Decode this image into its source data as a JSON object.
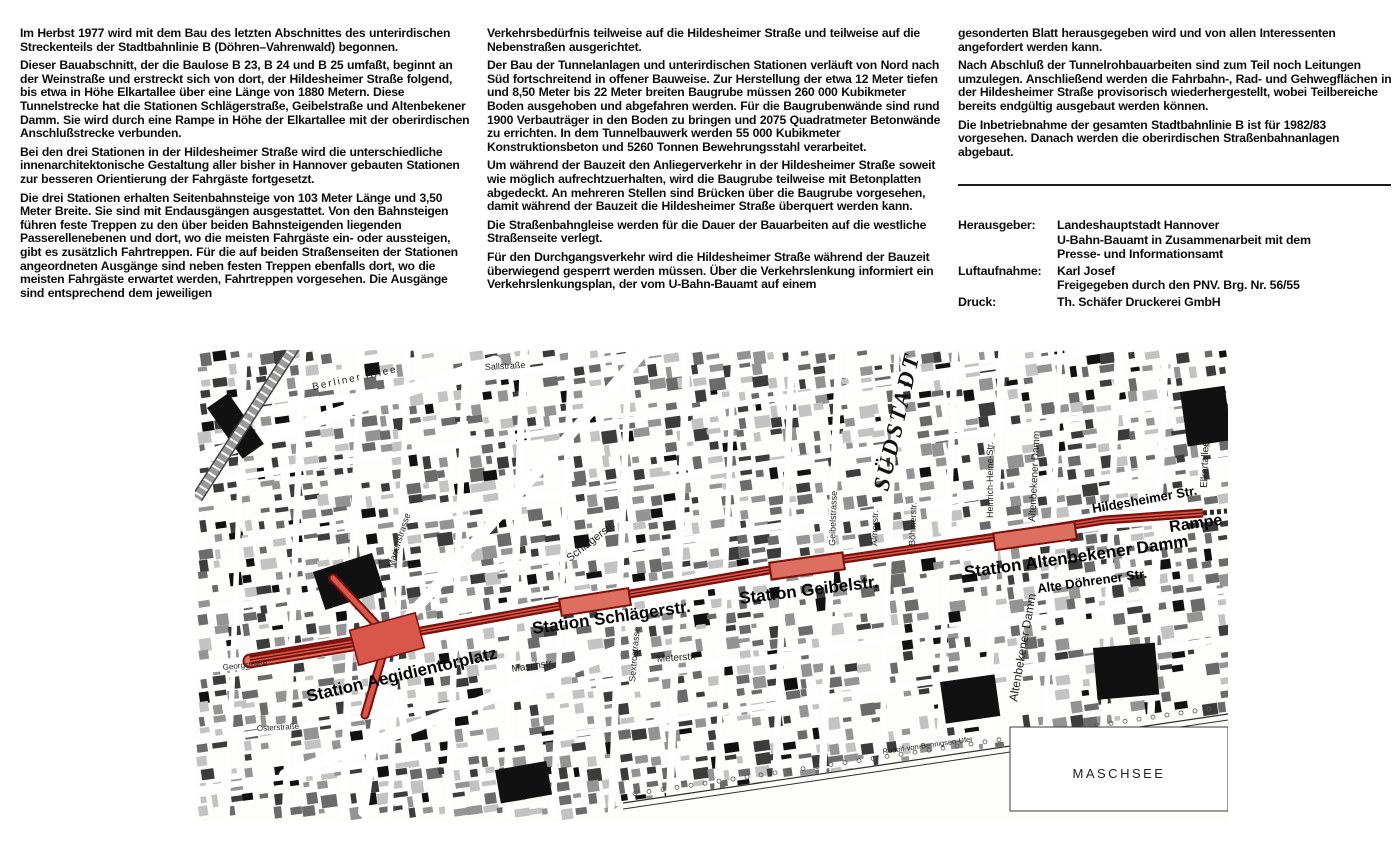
{
  "page": {
    "background": "#ffffff",
    "title": "Stadtbahnlinie B Hannover – Bauabschnitt Hildesheimer Straße"
  },
  "columns": [
    {
      "paragraphs": [
        "Im Herbst 1977 wird mit dem Bau des letzten Abschnittes des unterirdischen Streckenteils der Stadtbahnlinie B (Döhren–Vahrenwald) begonnen.",
        "Dieser Bauabschnitt, der die Baulose B 23, B 24 und B 25 umfaßt, beginnt an der Weinstraße und erstreckt sich von dort, der Hildesheimer Straße folgend, bis etwa in Höhe Elkartallee über eine Länge von 1880 Metern. Diese Tunnelstrecke hat die Stationen Schlägerstraße, Geibelstraße und Altenbekener Damm. Sie wird durch eine Rampe in Höhe der Elkartallee mit der oberirdischen Anschlußstrecke verbunden.",
        "Bei den drei Stationen in der Hildesheimer Straße wird die unterschiedliche innenarchitektonische Gestaltung aller bisher in Hannover gebauten Stationen zur besseren Orientierung der Fahrgäste fortgesetzt.",
        "Die drei Stationen erhalten Seitenbahnsteige von 103 Meter Länge und 3,50 Meter Breite. Sie sind mit Endausgängen ausgestattet. Von den Bahnsteigen führen feste Treppen zu den über beiden Bahnsteigenden liegenden Passerellenebenen und dort, wo die meisten Fahrgäste ein- oder aussteigen, gibt es zusätzlich Fahrtreppen. Für die auf beiden Straßenseiten der Stationen angeordneten Ausgänge sind neben festen Treppen ebenfalls dort, wo die meisten Fahrgäste erwartet werden, Fahrtreppen vorgesehen. Die Ausgänge sind entsprechend dem jeweiligen"
      ]
    },
    {
      "paragraphs": [
        "Verkehrsbedürfnis teilweise auf die Hildesheimer Straße und teilweise auf die Nebenstraßen ausgerichtet.",
        "Der Bau der Tunnelanlagen und unterirdischen Stationen verläuft von Nord nach Süd fortschreitend in offener Bauweise. Zur Herstellung der etwa 12 Meter tiefen und 8,50 Meter bis 22 Meter breiten Baugrube müssen 260 000 Kubikmeter Boden ausgehoben und abgefahren werden. Für die Baugrubenwände sind rund 1900 Verbauträger in den Boden zu bringen und 2075 Quadratmeter Betonwände zu errichten. In dem Tunnelbauwerk werden 55 000 Kubikmeter Konstruktionsbeton und 5260 Tonnen Bewehrungsstahl verarbeitet.",
        "Um während der Bauzeit den Anliegerverkehr in der Hildesheimer Straße soweit wie möglich aufrechtzuerhalten, wird die Baugrube teilweise mit Betonplatten abgedeckt. An mehreren Stellen sind Brücken über die Baugrube vorgesehen, damit während der Bauzeit die Hildesheimer Straße überquert werden kann.",
        "Die Straßenbahngleise werden für die Dauer der Bauarbeiten auf die westliche Straßenseite verlegt.",
        "Für den Durchgangsverkehr wird die Hildesheimer Straße während der Bauzeit überwiegend gesperrt werden müssen. Über die Verkehrslenkung informiert ein Verkehrslenkungsplan, der vom U-Bahn-Bauamt auf einem"
      ]
    },
    {
      "paragraphs": [
        "gesonderten Blatt herausgegeben wird und von allen Interessenten angefordert werden kann.",
        "Nach Abschluß der Tunnelrohbauarbeiten sind zum Teil noch Leitungen umzulegen. Anschließend werden die Fahrbahn-, Rad- und Gehwegflächen in der Hildesheimer Straße provisorisch wiederhergestellt, wobei Teilbereiche bereits endgültig ausgebaut werden können.",
        "Die Inbetriebnahme der gesamten Stadtbahnlinie B ist für 1982/83 vorgesehen. Danach werden die oberirdischen Straßenbahnanlagen abgebaut."
      ]
    }
  ],
  "imprint": {
    "rows": [
      {
        "label": "Herausgeber:",
        "lines": [
          "Landeshauptstadt Hannover",
          "U-Bahn-Bauamt in Zusammenarbeit mit dem",
          "Presse- und Informationsamt"
        ]
      },
      {
        "label": "Luftaufnahme:",
        "lines": [
          "Karl Josef",
          "Freigegeben durch den PNV. Brg. Nr. 56/55"
        ]
      },
      {
        "label": "Druck:",
        "lines": [
          "Th. Schäfer Druckerei GmbH"
        ]
      }
    ]
  },
  "map": {
    "colors": {
      "route_dark": "#7c100a",
      "route_fill": "#d8564a",
      "station_fill": "#dd6f60",
      "building_dark": "#111111",
      "label": "#1a1a1a"
    },
    "route": {
      "main": [
        [
          55,
          310
        ],
        [
          193,
          287
        ],
        [
          370,
          255
        ],
        [
          500,
          233
        ],
        [
          580,
          219
        ],
        [
          815,
          185
        ],
        [
          910,
          170
        ],
        [
          1008,
          163
        ]
      ],
      "approach": [
        [
          55,
          311
        ],
        [
          193,
          288
        ]
      ],
      "branches": [
        [
          [
            193,
            287
          ],
          [
            138,
            228
          ]
        ],
        [
          [
            193,
            287
          ],
          [
            170,
            365
          ]
        ]
      ],
      "junction": {
        "x": 192,
        "y": 289,
        "w": 68,
        "h": 36,
        "rot": -15
      },
      "station_boxes": [
        {
          "x": 400,
          "y": 252,
          "w": 70,
          "h": 17,
          "rot": -9
        },
        {
          "x": 612,
          "y": 216,
          "w": 74,
          "h": 17,
          "rot": -8
        },
        {
          "x": 840,
          "y": 186,
          "w": 82,
          "h": 17,
          "rot": -8
        }
      ],
      "ramp_dash": [
        [
          1008,
          163
        ],
        [
          1032,
          161
        ]
      ]
    },
    "station_labels": [
      {
        "text": "Station Aegidientorplatz",
        "x": 113,
        "y": 352,
        "rot": -13,
        "size": 17
      },
      {
        "text": "Station Schlägerstr.",
        "x": 338,
        "y": 284,
        "rot": -8,
        "size": 17
      },
      {
        "text": "Station Geibelstr.",
        "x": 545,
        "y": 254,
        "rot": -7,
        "size": 17
      },
      {
        "text": "Station Altenbekener Damm",
        "x": 770,
        "y": 228,
        "rot": -8,
        "size": 17
      },
      {
        "text": "Rampe",
        "x": 975,
        "y": 182,
        "rot": -8,
        "size": 16
      },
      {
        "text": "Alte Döhrener Str.",
        "x": 843,
        "y": 243,
        "rot": -8,
        "size": 13
      },
      {
        "text": "Hildesheimer Str.",
        "x": 898,
        "y": 163,
        "rot": -10,
        "size": 13
      }
    ],
    "street_labels": [
      {
        "text": "Sallstraße",
        "x": 290,
        "y": 20,
        "rot": -3,
        "size": 9
      },
      {
        "text": "Berliner Allee",
        "x": 118,
        "y": 40,
        "rot": -12,
        "size": 10,
        "ls": 2
      },
      {
        "text": "Marienstrasse",
        "x": 198,
        "y": 218,
        "rot": -72,
        "size": 9
      },
      {
        "text": "Schlägerstr.",
        "x": 375,
        "y": 212,
        "rot": -38,
        "size": 11
      },
      {
        "text": "Sextrostrasse",
        "x": 440,
        "y": 332,
        "rot": -85,
        "size": 9
      },
      {
        "text": "Meterstr.",
        "x": 462,
        "y": 312,
        "rot": -4,
        "size": 10
      },
      {
        "text": "Maschstr.",
        "x": 317,
        "y": 322,
        "rot": -8,
        "size": 10
      },
      {
        "text": "Geibelstrasse",
        "x": 640,
        "y": 196,
        "rot": -88,
        "size": 9
      },
      {
        "text": "Almerstr.",
        "x": 682,
        "y": 196,
        "rot": -88,
        "size": 9
      },
      {
        "text": "Böhmerstr.",
        "x": 720,
        "y": 196,
        "rot": -88,
        "size": 9
      },
      {
        "text": "Heinrich-Heine-Str.",
        "x": 798,
        "y": 168,
        "rot": -90,
        "size": 9
      },
      {
        "text": "Altenbekener Damm",
        "x": 840,
        "y": 172,
        "rot": -87,
        "size": 10
      },
      {
        "text": "Altenbekener Damm",
        "x": 822,
        "y": 352,
        "rot": -80,
        "size": 12
      },
      {
        "text": "Elkartallee",
        "x": 1012,
        "y": 138,
        "rot": -88,
        "size": 10
      },
      {
        "text": "Osterstraße",
        "x": 62,
        "y": 381,
        "rot": -3,
        "size": 8
      },
      {
        "text": "Georgstraße",
        "x": 28,
        "y": 320,
        "rot": -6,
        "size": 8
      },
      {
        "text": "Rudolf-von-Bennigsen-Ufer",
        "x": 688,
        "y": 404,
        "rot": -8,
        "size": 7.5
      }
    ],
    "area_labels": {
      "suedstadt": {
        "text": "SÜDSTADT",
        "x": 693,
        "y": 142,
        "rot": -77,
        "size": 23
      },
      "maschsee": {
        "text": "MASCHSEE",
        "x": 924,
        "y": 428,
        "size": 13
      },
      "maschsee_box": {
        "x": 815,
        "y": 377,
        "w": 218,
        "h": 84
      }
    }
  }
}
